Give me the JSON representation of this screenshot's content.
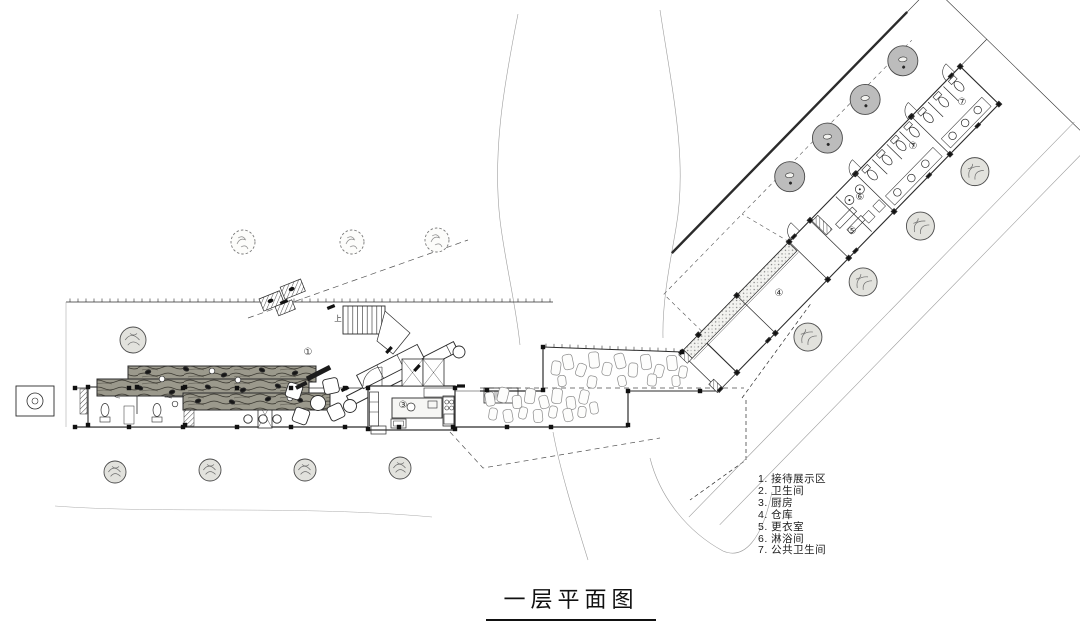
{
  "title": {
    "text": "一层平面图"
  },
  "legend": {
    "items": [
      "1. 接待展示区",
      "2. 卫生间",
      "3. 厨房",
      "4. 仓库",
      "5. 更衣室",
      "6. 淋浴间",
      "7. 公共卫生间"
    ]
  },
  "plan": {
    "labels": {
      "reception": {
        "text": "①"
      },
      "kitchen": {
        "text": "③"
      },
      "storage": {
        "text": "④"
      },
      "changing": {
        "text": "⑤"
      },
      "shower": {
        "text": "⑥"
      },
      "public_toilet_a": {
        "text": "⑦"
      },
      "public_toilet_b": {
        "text": "⑦"
      },
      "stair_up": {
        "text": "上"
      }
    },
    "colors": {
      "line": "#2b2b2b",
      "light_line": "#999999",
      "tree_gray": "#bcbcbc",
      "wood": "#9b998c"
    }
  }
}
